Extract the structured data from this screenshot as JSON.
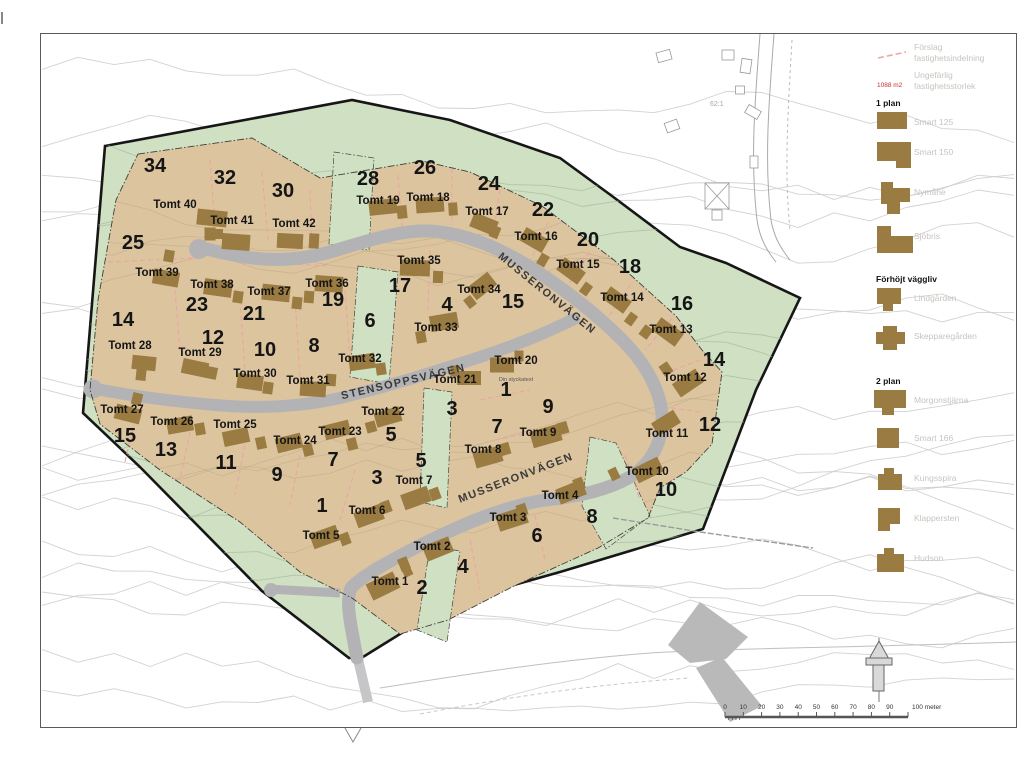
{
  "map": {
    "streets": [
      {
        "name": "MUSSERONVÄGEN",
        "x": 545,
        "y": 296,
        "rot": 39
      },
      {
        "name": "STENSOPPSVÄGEN",
        "x": 404,
        "y": 385,
        "rot": -13
      },
      {
        "name": "MUSSERONVÄGEN",
        "x": 517,
        "y": 481,
        "rot": -21
      }
    ],
    "annotation": {
      "text": "Din styckatext",
      "x": 516,
      "y": 381
    },
    "basemap_label": {
      "text": "62:1",
      "x": 710,
      "y": 106
    },
    "block_numbers": [
      {
        "v": "34",
        "x": 155,
        "y": 172
      },
      {
        "v": "32",
        "x": 225,
        "y": 184
      },
      {
        "v": "30",
        "x": 283,
        "y": 197
      },
      {
        "v": "28",
        "x": 368,
        "y": 185
      },
      {
        "v": "26",
        "x": 425,
        "y": 174
      },
      {
        "v": "24",
        "x": 489,
        "y": 190
      },
      {
        "v": "22",
        "x": 543,
        "y": 216
      },
      {
        "v": "20",
        "x": 588,
        "y": 246
      },
      {
        "v": "18",
        "x": 630,
        "y": 273
      },
      {
        "v": "16",
        "x": 682,
        "y": 310
      },
      {
        "v": "25",
        "x": 133,
        "y": 249
      },
      {
        "v": "23",
        "x": 197,
        "y": 311
      },
      {
        "v": "21",
        "x": 254,
        "y": 320
      },
      {
        "v": "19",
        "x": 333,
        "y": 306
      },
      {
        "v": "17",
        "x": 400,
        "y": 292
      },
      {
        "v": "15",
        "x": 513,
        "y": 308
      },
      {
        "v": "14",
        "x": 123,
        "y": 326
      },
      {
        "v": "12",
        "x": 213,
        "y": 344
      },
      {
        "v": "10",
        "x": 265,
        "y": 356
      },
      {
        "v": "8",
        "x": 314,
        "y": 352
      },
      {
        "v": "6",
        "x": 370,
        "y": 327
      },
      {
        "v": "4",
        "x": 447,
        "y": 311
      },
      {
        "v": "14",
        "x": 714,
        "y": 366
      },
      {
        "v": "12",
        "x": 710,
        "y": 431
      },
      {
        "v": "15",
        "x": 125,
        "y": 442
      },
      {
        "v": "13",
        "x": 166,
        "y": 456
      },
      {
        "v": "11",
        "x": 226,
        "y": 469
      },
      {
        "v": "9",
        "x": 277,
        "y": 481
      },
      {
        "v": "7",
        "x": 333,
        "y": 466
      },
      {
        "v": "5",
        "x": 391,
        "y": 441
      },
      {
        "v": "3",
        "x": 377,
        "y": 484
      },
      {
        "v": "1",
        "x": 322,
        "y": 512
      },
      {
        "v": "5",
        "x": 421,
        "y": 467
      },
      {
        "v": "3",
        "x": 452,
        "y": 415
      },
      {
        "v": "7",
        "x": 497,
        "y": 433
      },
      {
        "v": "9",
        "x": 548,
        "y": 413
      },
      {
        "v": "1",
        "x": 506,
        "y": 396
      },
      {
        "v": "2",
        "x": 422,
        "y": 594
      },
      {
        "v": "4",
        "x": 463,
        "y": 573
      },
      {
        "v": "6",
        "x": 537,
        "y": 542
      },
      {
        "v": "8",
        "x": 592,
        "y": 523
      },
      {
        "v": "10",
        "x": 666,
        "y": 496
      }
    ],
    "plots": [
      {
        "name": "Tomt 1",
        "x": 390,
        "y": 585
      },
      {
        "name": "Tomt 2",
        "x": 432,
        "y": 550
      },
      {
        "name": "Tomt 3",
        "x": 508,
        "y": 521
      },
      {
        "name": "Tomt 4",
        "x": 560,
        "y": 499
      },
      {
        "name": "Tomt 5",
        "x": 321,
        "y": 539
      },
      {
        "name": "Tomt 6",
        "x": 367,
        "y": 514
      },
      {
        "name": "Tomt 7",
        "x": 414,
        "y": 484
      },
      {
        "name": "Tomt 8",
        "x": 483,
        "y": 453
      },
      {
        "name": "Tomt 9",
        "x": 538,
        "y": 436
      },
      {
        "name": "Tomt 10",
        "x": 647,
        "y": 475
      },
      {
        "name": "Tomt 11",
        "x": 667,
        "y": 437
      },
      {
        "name": "Tomt 12",
        "x": 685,
        "y": 381
      },
      {
        "name": "Tomt 13",
        "x": 671,
        "y": 333
      },
      {
        "name": "Tomt 14",
        "x": 622,
        "y": 301
      },
      {
        "name": "Tomt 15",
        "x": 578,
        "y": 268
      },
      {
        "name": "Tomt 16",
        "x": 536,
        "y": 240
      },
      {
        "name": "Tomt 17",
        "x": 487,
        "y": 215
      },
      {
        "name": "Tomt 18",
        "x": 428,
        "y": 201
      },
      {
        "name": "Tomt 19",
        "x": 378,
        "y": 204
      },
      {
        "name": "Tomt 20",
        "x": 516,
        "y": 364
      },
      {
        "name": "Tomt 21",
        "x": 455,
        "y": 383
      },
      {
        "name": "Tomt 22",
        "x": 383,
        "y": 415
      },
      {
        "name": "Tomt 23",
        "x": 340,
        "y": 435
      },
      {
        "name": "Tomt 24",
        "x": 295,
        "y": 444
      },
      {
        "name": "Tomt 25",
        "x": 235,
        "y": 428
      },
      {
        "name": "Tomt 26",
        "x": 172,
        "y": 425
      },
      {
        "name": "Tomt 27",
        "x": 122,
        "y": 413
      },
      {
        "name": "Tomt 28",
        "x": 130,
        "y": 349
      },
      {
        "name": "Tomt 29",
        "x": 200,
        "y": 356
      },
      {
        "name": "Tomt 30",
        "x": 255,
        "y": 377
      },
      {
        "name": "Tomt 31",
        "x": 308,
        "y": 384
      },
      {
        "name": "Tomt 32",
        "x": 360,
        "y": 362
      },
      {
        "name": "Tomt 33",
        "x": 436,
        "y": 331
      },
      {
        "name": "Tomt 34",
        "x": 479,
        "y": 293
      },
      {
        "name": "Tomt 35",
        "x": 419,
        "y": 264
      },
      {
        "name": "Tomt 36",
        "x": 327,
        "y": 287
      },
      {
        "name": "Tomt 37",
        "x": 269,
        "y": 295
      },
      {
        "name": "Tomt 38",
        "x": 212,
        "y": 288
      },
      {
        "name": "Tomt 39",
        "x": 157,
        "y": 276
      },
      {
        "name": "Tomt 40",
        "x": 175,
        "y": 208
      },
      {
        "name": "Tomt 41",
        "x": 232,
        "y": 224
      },
      {
        "name": "Tomt 42",
        "x": 294,
        "y": 227
      }
    ],
    "houses": [
      {
        "x": 212,
        "y": 218,
        "w": 30,
        "h": 16,
        "r": 6
      },
      {
        "x": 217,
        "y": 234,
        "w": 12,
        "h": 10,
        "r": 0
      },
      {
        "x": 236,
        "y": 242,
        "w": 28,
        "h": 16,
        "r": 4
      },
      {
        "x": 210,
        "y": 234,
        "w": 11,
        "h": 13,
        "r": 0
      },
      {
        "x": 290,
        "y": 241,
        "w": 26,
        "h": 15,
        "r": 3
      },
      {
        "x": 314,
        "y": 241,
        "w": 10,
        "h": 15,
        "r": 3
      },
      {
        "x": 383,
        "y": 207,
        "w": 28,
        "h": 15,
        "r": -6
      },
      {
        "x": 402,
        "y": 212,
        "w": 10,
        "h": 13,
        "r": -6
      },
      {
        "x": 430,
        "y": 205,
        "w": 28,
        "h": 15,
        "r": -4
      },
      {
        "x": 453,
        "y": 209,
        "w": 9,
        "h": 13,
        "r": -4
      },
      {
        "x": 484,
        "y": 224,
        "w": 26,
        "h": 15,
        "r": 22
      },
      {
        "x": 495,
        "y": 232,
        "w": 9,
        "h": 12,
        "r": 22
      },
      {
        "x": 534,
        "y": 240,
        "w": 26,
        "h": 15,
        "r": 30
      },
      {
        "x": 543,
        "y": 260,
        "w": 9,
        "h": 12,
        "r": 30
      },
      {
        "x": 571,
        "y": 271,
        "w": 26,
        "h": 15,
        "r": 36
      },
      {
        "x": 586,
        "y": 289,
        "w": 9,
        "h": 12,
        "r": 36
      },
      {
        "x": 617,
        "y": 300,
        "w": 26,
        "h": 15,
        "r": 36
      },
      {
        "x": 631,
        "y": 319,
        "w": 9,
        "h": 12,
        "r": 36
      },
      {
        "x": 668,
        "y": 332,
        "w": 28,
        "h": 16,
        "r": 36
      },
      {
        "x": 646,
        "y": 332,
        "w": 10,
        "h": 12,
        "r": 36
      },
      {
        "x": 688,
        "y": 383,
        "w": 28,
        "h": 16,
        "r": -34
      },
      {
        "x": 666,
        "y": 369,
        "w": 10,
        "h": 12,
        "r": -34
      },
      {
        "x": 666,
        "y": 423,
        "w": 26,
        "h": 15,
        "r": -32
      },
      {
        "x": 648,
        "y": 470,
        "w": 28,
        "h": 16,
        "r": -26
      },
      {
        "x": 614,
        "y": 474,
        "w": 9,
        "h": 12,
        "r": -26
      },
      {
        "x": 415,
        "y": 268,
        "w": 30,
        "h": 16,
        "r": 2
      },
      {
        "x": 438,
        "y": 277,
        "w": 10,
        "h": 12,
        "r": 2
      },
      {
        "x": 482,
        "y": 286,
        "w": 26,
        "h": 16,
        "r": -38
      },
      {
        "x": 470,
        "y": 302,
        "w": 9,
        "h": 11,
        "r": -38
      },
      {
        "x": 444,
        "y": 322,
        "w": 28,
        "h": 16,
        "r": -10
      },
      {
        "x": 421,
        "y": 337,
        "w": 10,
        "h": 12,
        "r": -10
      },
      {
        "x": 329,
        "y": 284,
        "w": 28,
        "h": 16,
        "r": 4
      },
      {
        "x": 309,
        "y": 297,
        "w": 10,
        "h": 12,
        "r": 4
      },
      {
        "x": 276,
        "y": 293,
        "w": 28,
        "h": 16,
        "r": 6
      },
      {
        "x": 297,
        "y": 303,
        "w": 10,
        "h": 12,
        "r": 6
      },
      {
        "x": 218,
        "y": 288,
        "w": 28,
        "h": 16,
        "r": 8
      },
      {
        "x": 238,
        "y": 297,
        "w": 10,
        "h": 12,
        "r": 8
      },
      {
        "x": 166,
        "y": 278,
        "w": 26,
        "h": 15,
        "r": 10
      },
      {
        "x": 169,
        "y": 256,
        "w": 10,
        "h": 12,
        "r": 10
      },
      {
        "x": 144,
        "y": 363,
        "w": 24,
        "h": 14,
        "r": 6
      },
      {
        "x": 141,
        "y": 375,
        "w": 10,
        "h": 11,
        "r": 6
      },
      {
        "x": 195,
        "y": 368,
        "w": 26,
        "h": 15,
        "r": 12
      },
      {
        "x": 212,
        "y": 373,
        "w": 10,
        "h": 12,
        "r": 12
      },
      {
        "x": 250,
        "y": 382,
        "w": 26,
        "h": 15,
        "r": 8
      },
      {
        "x": 268,
        "y": 388,
        "w": 10,
        "h": 12,
        "r": 8
      },
      {
        "x": 313,
        "y": 389,
        "w": 26,
        "h": 15,
        "r": 4
      },
      {
        "x": 331,
        "y": 380,
        "w": 10,
        "h": 12,
        "r": 4
      },
      {
        "x": 362,
        "y": 362,
        "w": 26,
        "h": 15,
        "r": -8
      },
      {
        "x": 381,
        "y": 369,
        "w": 10,
        "h": 12,
        "r": -8
      },
      {
        "x": 502,
        "y": 365,
        "w": 24,
        "h": 15,
        "r": 0
      },
      {
        "x": 519,
        "y": 356,
        "w": 9,
        "h": 11,
        "r": 0
      },
      {
        "x": 469,
        "y": 378,
        "w": 24,
        "h": 14,
        "r": 0
      },
      {
        "x": 455,
        "y": 371,
        "w": 9,
        "h": 11,
        "r": 0
      },
      {
        "x": 546,
        "y": 436,
        "w": 30,
        "h": 17,
        "r": -16
      },
      {
        "x": 563,
        "y": 428,
        "w": 10,
        "h": 12,
        "r": -16
      },
      {
        "x": 488,
        "y": 457,
        "w": 28,
        "h": 16,
        "r": -16
      },
      {
        "x": 505,
        "y": 449,
        "w": 10,
        "h": 12,
        "r": -16
      },
      {
        "x": 128,
        "y": 414,
        "w": 26,
        "h": 15,
        "r": 14
      },
      {
        "x": 137,
        "y": 399,
        "w": 10,
        "h": 12,
        "r": 14
      },
      {
        "x": 180,
        "y": 425,
        "w": 26,
        "h": 15,
        "r": -10
      },
      {
        "x": 200,
        "y": 429,
        "w": 10,
        "h": 12,
        "r": -10
      },
      {
        "x": 236,
        "y": 437,
        "w": 26,
        "h": 15,
        "r": -12
      },
      {
        "x": 261,
        "y": 443,
        "w": 10,
        "h": 12,
        "r": -12
      },
      {
        "x": 289,
        "y": 443,
        "w": 26,
        "h": 15,
        "r": -14
      },
      {
        "x": 308,
        "y": 450,
        "w": 10,
        "h": 12,
        "r": -14
      },
      {
        "x": 337,
        "y": 430,
        "w": 26,
        "h": 15,
        "r": -14
      },
      {
        "x": 352,
        "y": 444,
        "w": 10,
        "h": 12,
        "r": -14
      },
      {
        "x": 388,
        "y": 417,
        "w": 26,
        "h": 15,
        "r": -16
      },
      {
        "x": 371,
        "y": 427,
        "w": 10,
        "h": 11,
        "r": -16
      },
      {
        "x": 416,
        "y": 498,
        "w": 28,
        "h": 16,
        "r": -20
      },
      {
        "x": 435,
        "y": 494,
        "w": 10,
        "h": 12,
        "r": -20
      },
      {
        "x": 369,
        "y": 516,
        "w": 28,
        "h": 16,
        "r": -20
      },
      {
        "x": 386,
        "y": 507,
        "w": 10,
        "h": 12,
        "r": -20
      },
      {
        "x": 325,
        "y": 537,
        "w": 28,
        "h": 16,
        "r": -20
      },
      {
        "x": 345,
        "y": 539,
        "w": 10,
        "h": 12,
        "r": -20
      },
      {
        "x": 571,
        "y": 492,
        "w": 28,
        "h": 16,
        "r": -22
      },
      {
        "x": 579,
        "y": 484,
        "w": 10,
        "h": 12,
        "r": -22
      },
      {
        "x": 512,
        "y": 519,
        "w": 30,
        "h": 17,
        "r": -18
      },
      {
        "x": 522,
        "y": 510,
        "w": 10,
        "h": 12,
        "r": -18
      },
      {
        "x": 438,
        "y": 549,
        "w": 28,
        "h": 16,
        "r": -22
      },
      {
        "x": 404,
        "y": 564,
        "w": 10,
        "h": 13,
        "r": -22
      },
      {
        "x": 383,
        "y": 586,
        "w": 30,
        "h": 18,
        "r": -26
      },
      {
        "x": 407,
        "y": 571,
        "w": 9,
        "h": 11,
        "r": -26
      }
    ],
    "pink_lines": [
      [
        210,
        160,
        216,
        238
      ],
      [
        262,
        172,
        268,
        240
      ],
      [
        310,
        190,
        312,
        248
      ],
      [
        398,
        175,
        402,
        228
      ],
      [
        452,
        168,
        452,
        225
      ],
      [
        500,
        190,
        492,
        240
      ],
      [
        548,
        222,
        530,
        262
      ],
      [
        590,
        252,
        565,
        290
      ],
      [
        630,
        285,
        605,
        322
      ],
      [
        672,
        318,
        645,
        350
      ],
      [
        700,
        360,
        668,
        372
      ],
      [
        700,
        412,
        672,
        408
      ],
      [
        108,
        262,
        195,
        258
      ],
      [
        250,
        262,
        330,
        266
      ],
      [
        175,
        290,
        180,
        352
      ],
      [
        240,
        300,
        245,
        372
      ],
      [
        295,
        300,
        300,
        378
      ],
      [
        345,
        290,
        350,
        360
      ],
      [
        430,
        250,
        428,
        310
      ],
      [
        480,
        400,
        530,
        390
      ],
      [
        495,
        440,
        545,
        430
      ],
      [
        355,
        470,
        340,
        520
      ],
      [
        300,
        455,
        290,
        505
      ],
      [
        245,
        445,
        235,
        495
      ],
      [
        190,
        432,
        180,
        480
      ],
      [
        135,
        418,
        125,
        462
      ],
      [
        470,
        540,
        480,
        590
      ],
      [
        535,
        515,
        545,
        560
      ],
      [
        625,
        455,
        640,
        500
      ]
    ]
  },
  "legend": {
    "top_items": [
      {
        "symbol": "dashed-line",
        "symbol_text": "",
        "lines": [
          "Förslag",
          "fastighetsindelning"
        ]
      },
      {
        "symbol": "area-text",
        "symbol_text": "1088 m2",
        "lines": [
          "Ungefärlig",
          "fastighetsstorlek"
        ]
      }
    ],
    "sections": [
      {
        "heading": "1 plan",
        "items": [
          "Smart 125",
          "Smart 150",
          "Nymåne",
          "Sjöbris"
        ]
      },
      {
        "heading": "Förhöjt väggliv",
        "items": [
          "Lindgården",
          "Skepparegården"
        ]
      },
      {
        "heading": "2 plan",
        "items": [
          "Morgonstjärna",
          "Smart 166",
          "Kungsspira",
          "Klappersten",
          "Hudson"
        ]
      }
    ]
  },
  "scalebar": {
    "tick_labels": [
      "0",
      "10",
      "20",
      "30",
      "40",
      "50",
      "60",
      "70",
      "80",
      "90"
    ],
    "end_label": "100 meter"
  },
  "colors": {
    "green": "#cfe0c3",
    "tan": "#dcc49f",
    "house": "#9a7b41",
    "road": "#b3b3b6",
    "road_outside": "#c6c6c9",
    "boundary": "#161616",
    "pink": "#eda4a4",
    "red": "#c03030",
    "legend_text": "#c7c4be",
    "ink": "#151515",
    "contour_out": "#cdcdcd",
    "contour_green": "#a3b797",
    "contour_tan": "#a2906f",
    "basemap": "#a9a9a9"
  }
}
